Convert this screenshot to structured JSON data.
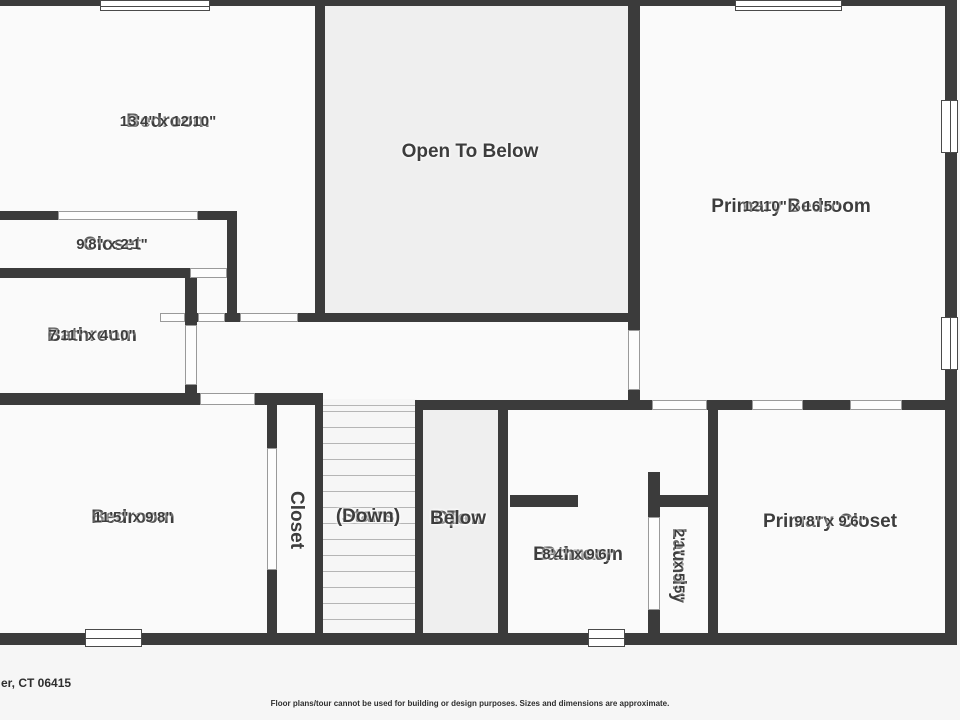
{
  "plan": {
    "wall_color": "#3b3b3b",
    "room_fill": "#fafafa",
    "open_fill": "#efefef",
    "stairs_fill": "#f6f6f6",
    "base": {
      "x": 0,
      "y": 0,
      "w": 957,
      "h": 645
    },
    "open_areas": [
      {
        "id": "open-to-below-top",
        "x": 320,
        "y": 3,
        "w": 315,
        "h": 315
      },
      {
        "id": "open-to-below-bottom",
        "x": 419,
        "y": 403,
        "w": 85,
        "h": 235
      }
    ],
    "stairs_area": {
      "x": 319,
      "y": 399,
      "w": 98,
      "h": 240
    },
    "treads": {
      "x": 323,
      "w": 92,
      "ys": [
        405,
        411,
        427,
        443,
        459,
        475,
        491,
        507,
        523,
        539,
        555,
        571,
        587,
        603,
        619
      ]
    },
    "walls": [
      [
        0,
        0,
        957,
        6
      ],
      [
        0,
        211,
        237,
        9
      ],
      [
        0,
        268,
        190,
        10
      ],
      [
        185,
        313,
        13,
        9
      ],
      [
        225,
        313,
        15,
        9
      ],
      [
        298,
        313,
        330,
        9
      ],
      [
        0,
        393,
        200,
        12
      ],
      [
        255,
        393,
        67,
        12
      ],
      [
        415,
        400,
        237,
        10
      ],
      [
        707,
        400,
        45,
        10
      ],
      [
        803,
        400,
        47,
        10
      ],
      [
        902,
        400,
        55,
        10
      ],
      [
        510,
        495,
        68,
        12
      ],
      [
        648,
        495,
        70,
        12
      ],
      [
        0,
        633,
        957,
        12
      ],
      [
        315,
        0,
        10,
        322
      ],
      [
        628,
        0,
        12,
        330
      ],
      [
        628,
        390,
        12,
        20
      ],
      [
        945,
        0,
        12,
        645
      ],
      [
        227,
        211,
        10,
        102
      ],
      [
        185,
        278,
        12,
        47
      ],
      [
        185,
        385,
        12,
        10
      ],
      [
        267,
        393,
        10,
        55
      ],
      [
        267,
        570,
        10,
        75
      ],
      [
        315,
        393,
        8,
        252
      ],
      [
        415,
        400,
        8,
        245
      ],
      [
        498,
        400,
        10,
        245
      ],
      [
        648,
        472,
        12,
        45
      ],
      [
        648,
        610,
        12,
        35
      ],
      [
        708,
        400,
        10,
        245
      ]
    ],
    "doors": [
      [
        58,
        211,
        140,
        9
      ],
      [
        190,
        268,
        37,
        10
      ],
      [
        160,
        313,
        25,
        9
      ],
      [
        198,
        313,
        27,
        9
      ],
      [
        240,
        313,
        58,
        9
      ],
      [
        185,
        325,
        12,
        60
      ],
      [
        200,
        393,
        55,
        12
      ],
      [
        267,
        448,
        10,
        122
      ],
      [
        628,
        330,
        12,
        60
      ],
      [
        652,
        400,
        55,
        10
      ],
      [
        752,
        400,
        51,
        10
      ],
      [
        850,
        400,
        52,
        10
      ],
      [
        648,
        517,
        12,
        93
      ]
    ],
    "windows": [
      {
        "x": 100,
        "y": 0,
        "w": 110,
        "h": 11,
        "dir": "h"
      },
      {
        "x": 735,
        "y": 0,
        "w": 107,
        "h": 11,
        "dir": "h"
      },
      {
        "x": 941,
        "y": 100,
        "w": 17,
        "h": 53,
        "dir": "v"
      },
      {
        "x": 941,
        "y": 317,
        "w": 17,
        "h": 53,
        "dir": "v"
      },
      {
        "x": 85,
        "y": 629,
        "w": 57,
        "h": 18,
        "dir": "h"
      },
      {
        "x": 588,
        "y": 629,
        "w": 37,
        "h": 18,
        "dir": "h"
      }
    ],
    "rooms": [
      {
        "id": "bedroom-1",
        "name_lines": [
          "Bedroom"
        ],
        "dims": "13'4\" x 12'10\"",
        "cx": 168,
        "cy": 122
      },
      {
        "id": "open-to-below-top",
        "name_lines": [
          "Open To Below"
        ],
        "dims": "",
        "cx": 470,
        "cy": 152
      },
      {
        "id": "primary-bedroom",
        "name_lines": [
          "Primary Bedroom"
        ],
        "dims": "12'10\" x 16'5\"",
        "cx": 791,
        "cy": 207
      },
      {
        "id": "closet-1",
        "name_lines": [
          "Closet"
        ],
        "dims": "9'8\" x 2'1\"",
        "cx": 112,
        "cy": 245
      },
      {
        "id": "bathroom",
        "name_lines": [
          "Bathroom"
        ],
        "dims": "7'11\" x 4'10\"",
        "cx": 92,
        "cy": 336
      },
      {
        "id": "bedroom-2",
        "name_lines": [
          "Bedroom"
        ],
        "dims": "11'5\" x 9'8\"",
        "cx": 133,
        "cy": 518
      },
      {
        "id": "closet-2",
        "name_lines": [
          "Closet"
        ],
        "dims": "",
        "cx": 296,
        "cy": 520,
        "vertical": true
      },
      {
        "id": "stairs",
        "name_lines": [
          "Stairs",
          "(Down)"
        ],
        "dims": "",
        "cx": 368,
        "cy": 517
      },
      {
        "id": "open-to-below-bottom",
        "name_lines": [
          "Open",
          "To",
          "Below"
        ],
        "dims": "",
        "cx": 458,
        "cy": 519
      },
      {
        "id": "primary-bathroom",
        "name_lines": [
          "Primary",
          "Bathroom"
        ],
        "dims": "8'4\" x 9'6\"",
        "cx": 578,
        "cy": 555
      },
      {
        "id": "laundry",
        "name_lines": [
          "Laundry"
        ],
        "dims": "2'1\" x 5'5\"",
        "cx": 678,
        "cy": 565,
        "vertical": true
      },
      {
        "id": "primary-closet",
        "name_lines": [
          "Primary Closet"
        ],
        "dims": "9'8\" x 9'6\"",
        "cx": 830,
        "cy": 522
      }
    ]
  },
  "footer": {
    "address": "er, CT 06415",
    "disclaimer": "Floor plans/tour cannot be used for building or design purposes. Sizes and dimensions are approximate."
  }
}
